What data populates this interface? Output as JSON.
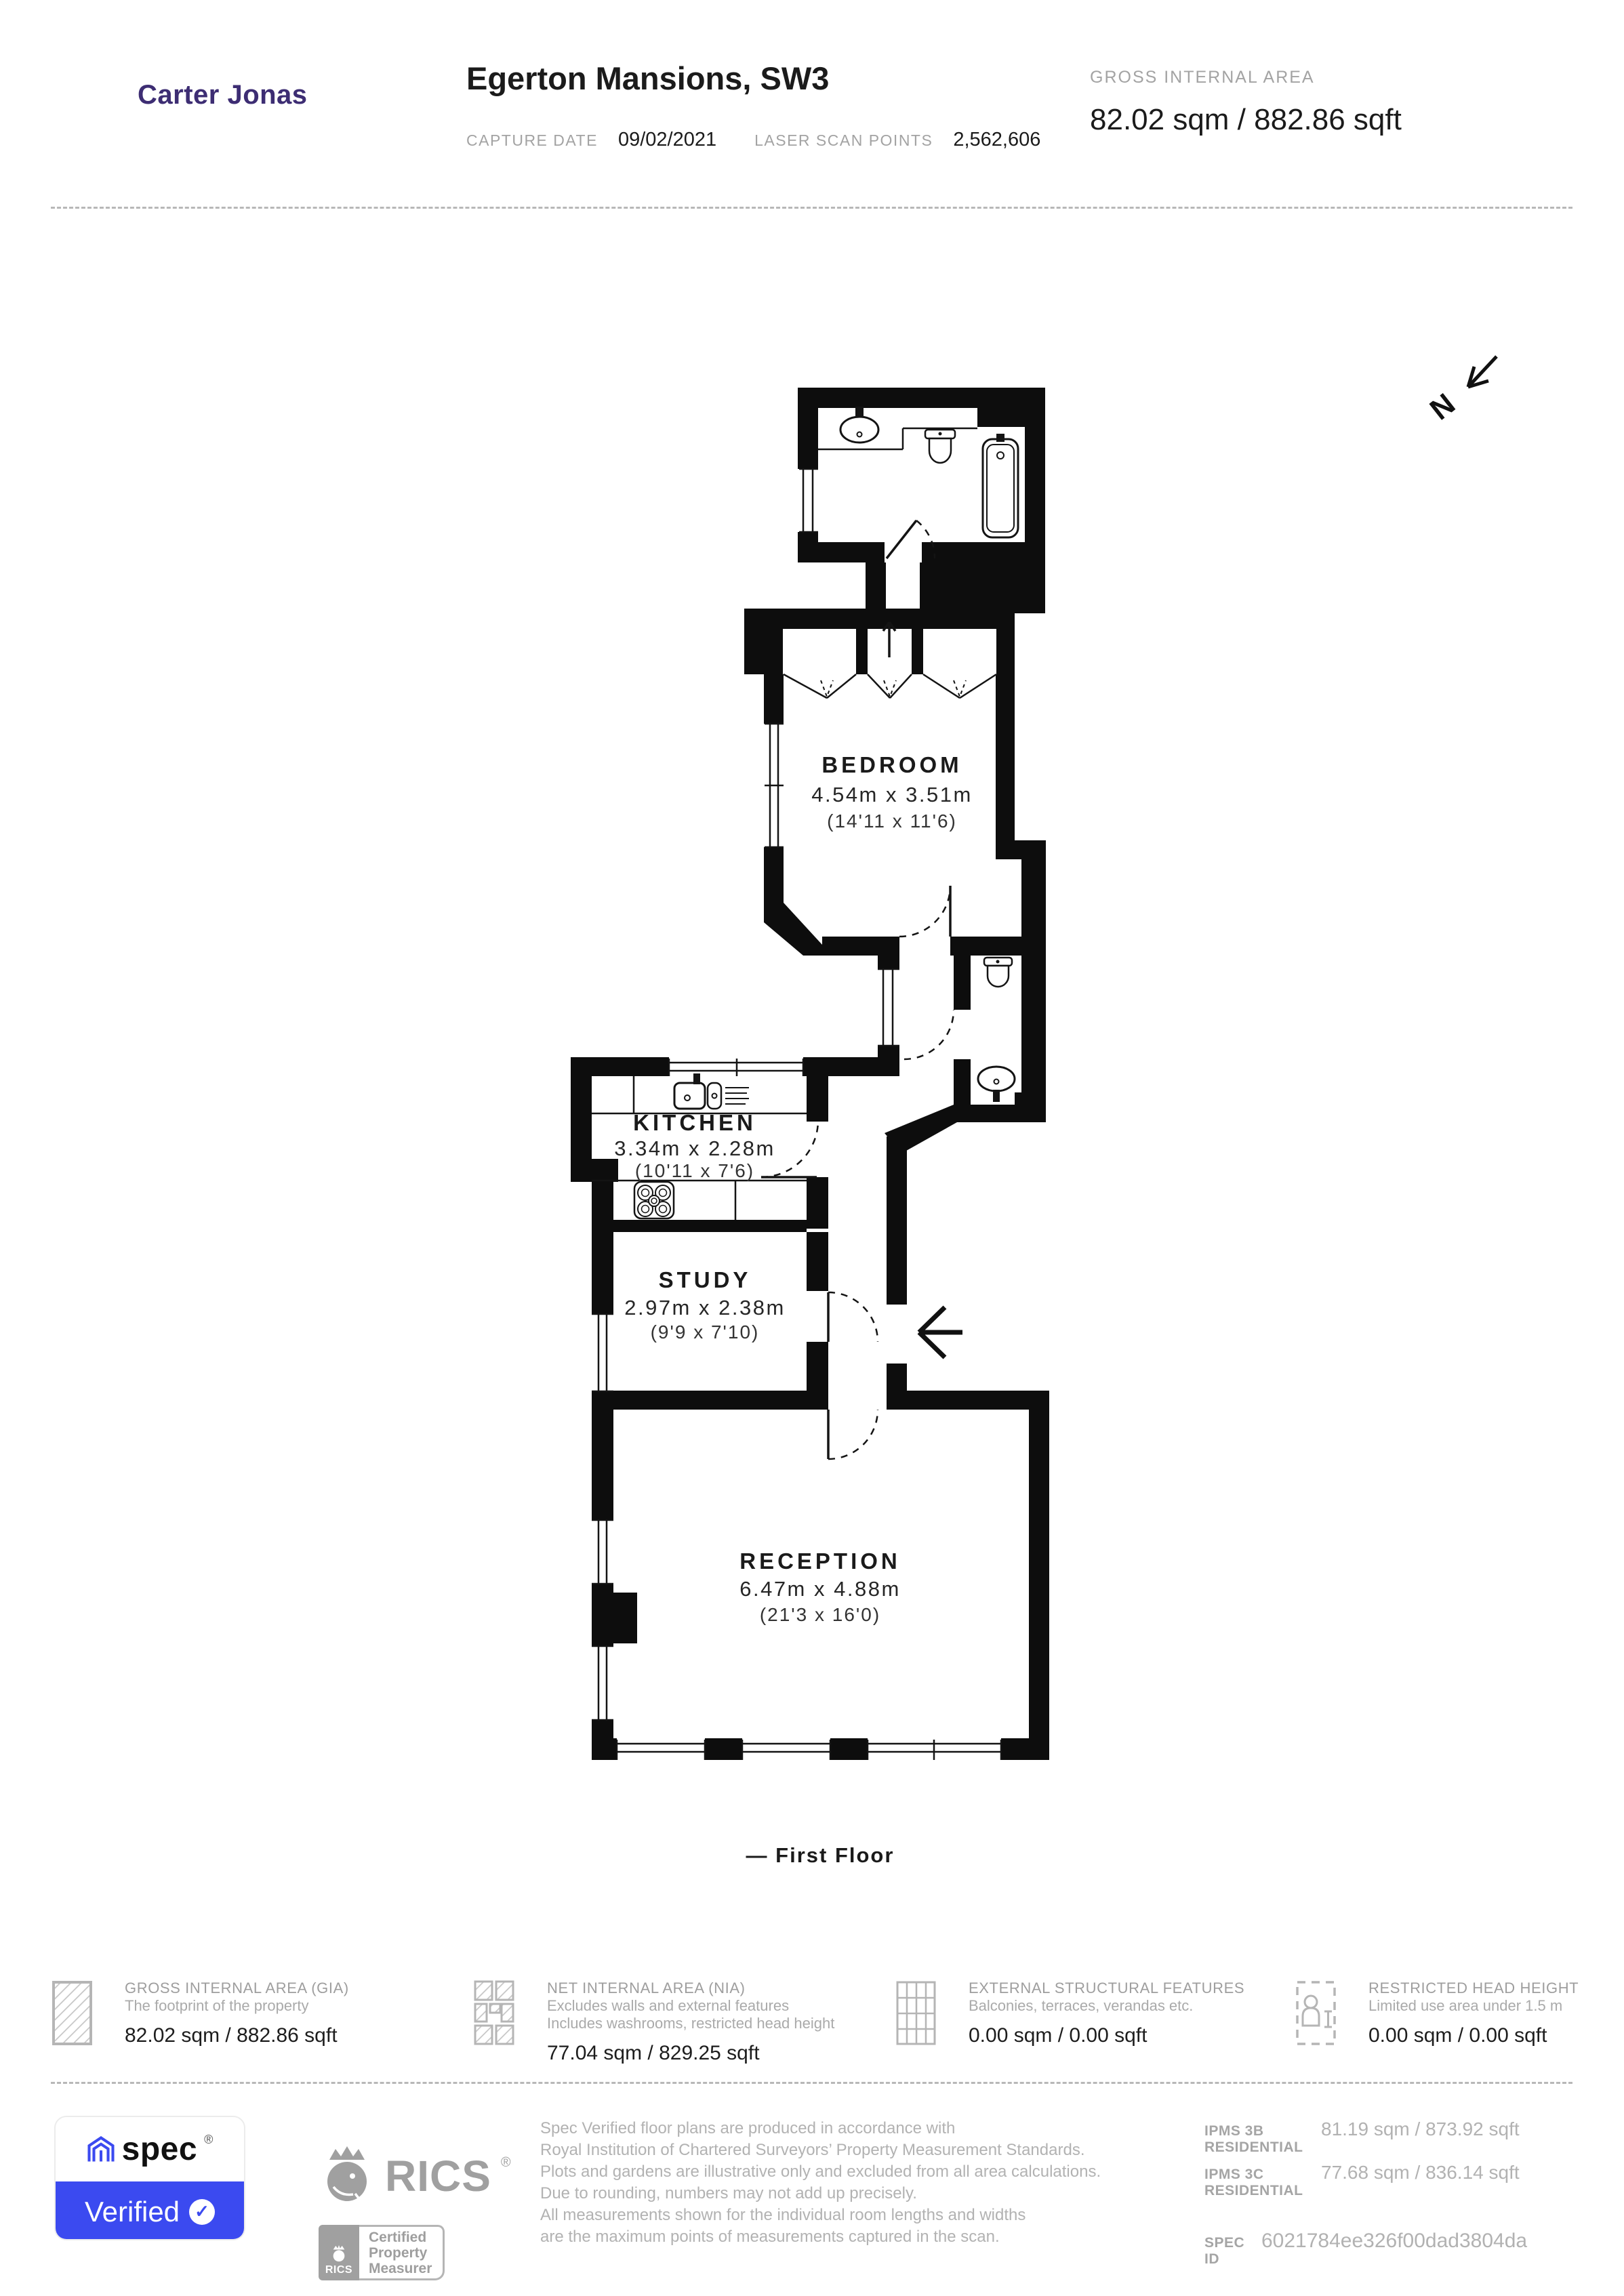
{
  "header": {
    "logo": "Carter Jonas",
    "title": "Egerton Mansions, SW3",
    "capture_date_label": "CAPTURE DATE",
    "capture_date": "09/02/2021",
    "laser_label": "LASER SCAN POINTS",
    "laser_points": "2,562,606",
    "gia_label": "GROSS INTERNAL AREA",
    "gia_value": "82.02 sqm / 882.86 sqft"
  },
  "plan": {
    "north_label": "N",
    "caption": "— First Floor",
    "rooms": [
      {
        "name": "BEDROOM",
        "metric": "4.54m x 3.51m",
        "imperial": "(14'11 x 11'6)"
      },
      {
        "name": "KITCHEN",
        "metric": "3.34m x 2.28m",
        "imperial": "(10'11 x 7'6)"
      },
      {
        "name": "STUDY",
        "metric": "2.97m x 2.38m",
        "imperial": "(9'9 x 7'10)"
      },
      {
        "name": "RECEPTION",
        "metric": "6.47m x 4.88m",
        "imperial": "(21'3 x 16'0)"
      }
    ]
  },
  "legend": [
    {
      "title": "GROSS INTERNAL AREA (GIA)",
      "line1": "The footprint of the property",
      "line2": "",
      "value": "82.02 sqm / 882.86 sqft"
    },
    {
      "title": "NET INTERNAL AREA (NIA)",
      "line1": "Excludes walls and external features",
      "line2": "Includes washrooms, restricted head height",
      "value": "77.04 sqm / 829.25 sqft"
    },
    {
      "title": "EXTERNAL STRUCTURAL FEATURES",
      "line1": "Balconies, terraces, verandas etc.",
      "line2": "",
      "value": "0.00 sqm / 0.00 sqft"
    },
    {
      "title": "RESTRICTED HEAD HEIGHT",
      "line1": "Limited use area under 1.5 m",
      "line2": "",
      "value": "0.00 sqm / 0.00 sqft"
    }
  ],
  "footer": {
    "spec_word": "spec",
    "reg": "®",
    "verified": "Verified",
    "check": "✓",
    "rics": "RICS",
    "rics_mini": "RICS",
    "cpm1": "Certified",
    "cpm2": "Property",
    "cpm3": "Measurer",
    "disclaimer": [
      "Spec Verified floor plans are produced in accordance with",
      "Royal Institution of Chartered Surveyors’ Property Measurement Standards.",
      "Plots and gardens are illustrative only and excluded from all area calculations.",
      "Due to rounding, numbers may not add up precisely.",
      "All measurements shown for the individual room lengths and widths",
      "are the maximum points of measurements captured in the scan."
    ],
    "ipms": [
      {
        "label": "IPMS 3B RESIDENTIAL",
        "value": "81.19 sqm / 873.92 sqft"
      },
      {
        "label": "IPMS 3C RESIDENTIAL",
        "value": "77.68 sqm / 836.14 sqft"
      }
    ],
    "spec_id_label": "SPEC ID",
    "spec_id": "6021784ee326f00dad3804da"
  }
}
